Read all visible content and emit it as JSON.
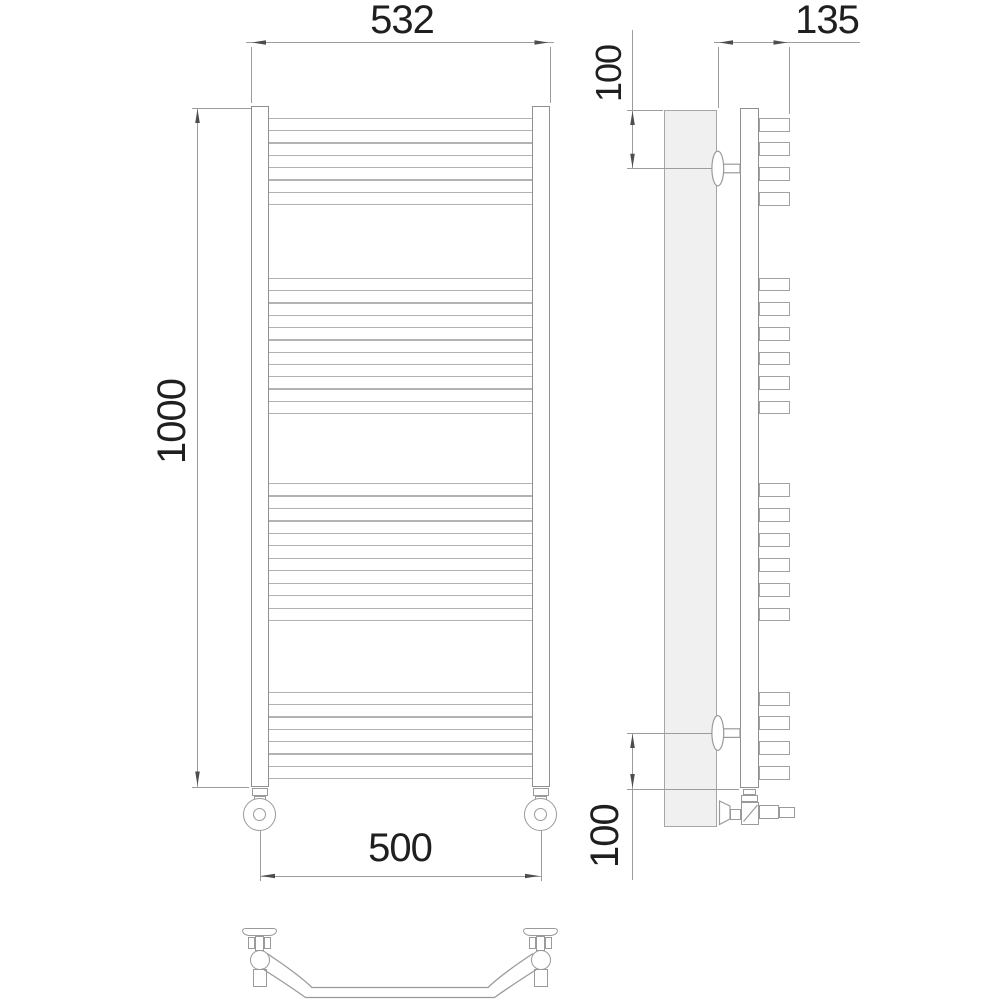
{
  "drawing": {
    "kind": "heated towel rail technical drawing",
    "views": {
      "front": {
        "name": "front-view",
        "tube_groups": [
          4,
          6,
          6,
          4
        ],
        "total_tubes": 20
      },
      "side": {
        "name": "side-view"
      },
      "top": {
        "name": "top-view"
      }
    },
    "dimensions": {
      "overall_width": {
        "value": "532",
        "orientation": "horizontal",
        "location": "top of front view"
      },
      "depth": {
        "value": "135",
        "orientation": "horizontal",
        "location": "top of side view"
      },
      "top_bracket_offset": {
        "value": "100",
        "orientation": "vertical",
        "location": "upper side view"
      },
      "overall_height": {
        "value": "1000",
        "orientation": "vertical",
        "location": "left of front view"
      },
      "pipe_center_distance": {
        "value": "500",
        "orientation": "horizontal",
        "location": "bottom of front view"
      },
      "bottom_bracket_offset": {
        "value": "100",
        "orientation": "vertical",
        "location": "lower side view"
      }
    },
    "colors": {
      "background": "#ffffff",
      "outline": "#8f8f8f",
      "rung_line": "#b3b3b3",
      "dimension_line": "#9c9c9c",
      "arrow": "#4d4d4d",
      "text": "#1f1f1f",
      "wall_fill": "#f0f0f0"
    }
  }
}
